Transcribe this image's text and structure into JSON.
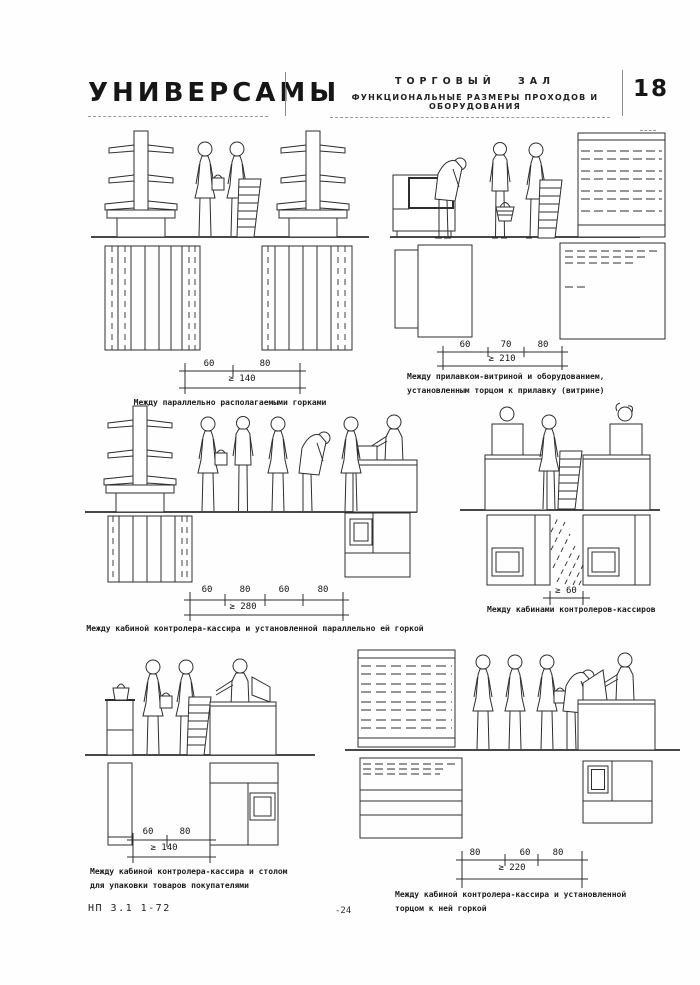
{
  "header": {
    "title": "УНИВЕРСАМЫ",
    "section": "ТОРГОВЫЙ ЗАЛ",
    "subtitle": "ФУНКЦИОНАЛЬНЫЕ РАЗМЕРЫ ПРОХОДОВ И ОБОРУДОВАНИЯ",
    "sheet_number": "18"
  },
  "footer": {
    "doc_code": "НП 3.1 1-72",
    "page_number": "-24"
  },
  "panels": [
    {
      "caption": "Между параллельно располагаемыми горками",
      "dims": [
        "60",
        "80"
      ],
      "total": "≥ 140"
    },
    {
      "caption": "Между прилавком-витриной и оборудованием,",
      "caption2": "установленным торцом к прилавку (витрине)",
      "dims": [
        "60",
        "70",
        "80"
      ],
      "total": "≥ 210"
    },
    {
      "caption": "Между кабиной контролера-кассира и установленной параллельно ей горкой",
      "dims": [
        "60",
        "80",
        "60",
        "80"
      ],
      "total": "≥ 280"
    },
    {
      "caption": "Между кабинами контролеров-кассиров",
      "dims": [],
      "total": "≥ 60"
    },
    {
      "caption": "Между кабиной контролера-кассира и столом",
      "caption2": "для упаковки товаров покупателями",
      "dims": [
        "60",
        "80"
      ],
      "total": "≥ 140"
    },
    {
      "caption": "Между кабиной контролера-кассира и установленной",
      "caption2": "торцом к ней горкой",
      "dims": [
        "80",
        "60",
        "80"
      ],
      "total": "≥ 220"
    }
  ]
}
